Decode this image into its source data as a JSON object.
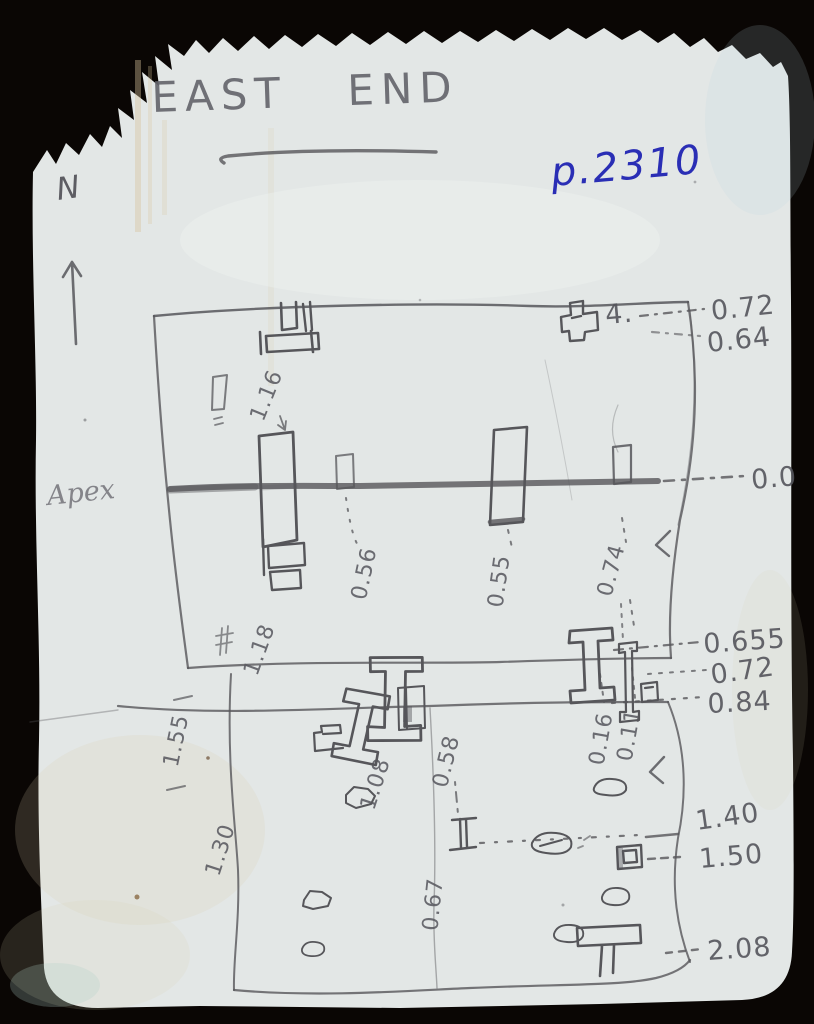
{
  "scan": {
    "background_color": "#0a0604",
    "paper_color": "#e3e7e6",
    "pencil_color": "#56565a",
    "ink_color": "#2a2eb5"
  },
  "header": {
    "title": "EAST END",
    "page_ref": "p.2310",
    "north_label": "N"
  },
  "labels": {
    "apex": "Apex",
    "post_mark": "4."
  },
  "elevations": [
    {
      "value": "0.72"
    },
    {
      "value": "0.64"
    },
    {
      "value": "0.0"
    },
    {
      "value": "0.655"
    },
    {
      "value": "0.72"
    },
    {
      "value": "0.84"
    },
    {
      "value": "1.40"
    },
    {
      "value": "1.50"
    },
    {
      "value": "2.08"
    }
  ],
  "measurements": [
    {
      "value": "1.16"
    },
    {
      "value": "1.18"
    },
    {
      "value": "0.56"
    },
    {
      "value": "0.55"
    },
    {
      "value": "0.74"
    },
    {
      "value": "1.55"
    },
    {
      "value": "1.08"
    },
    {
      "value": "1.30"
    },
    {
      "value": "0.58"
    },
    {
      "value": "0.16"
    },
    {
      "value": "0.11"
    },
    {
      "value": "0.67"
    }
  ]
}
